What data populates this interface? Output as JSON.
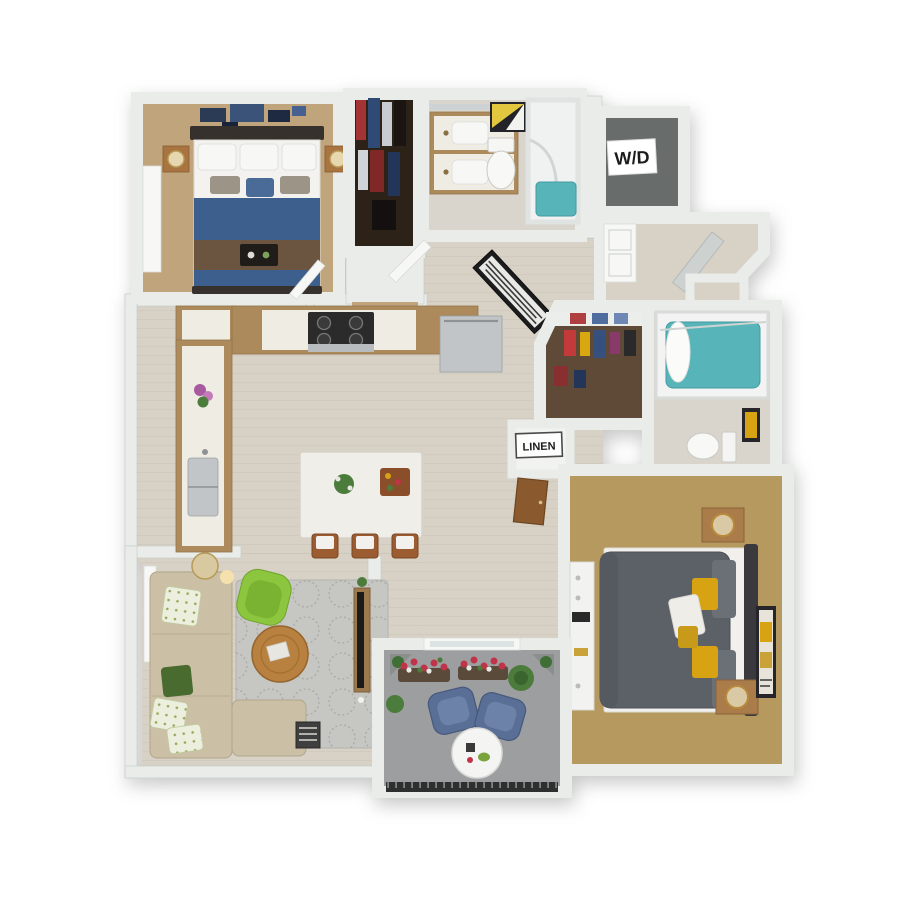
{
  "labels": {
    "washer_dryer": "W/D",
    "linen": "LINEN"
  },
  "palette": {
    "wall": "#e9ece9",
    "wall_edge": "#c7ccc9",
    "wood_floor": "#d7d1c6",
    "carpet_bedroom1": "#c0a47c",
    "carpet_bedroom2": "#b6995f",
    "closet_carpet_brown": "#5e4a36",
    "closet_interior_dark": "#2c2218",
    "laundry_interior": "#686c6b",
    "cabinet_wood": "#ac8a5c",
    "countertop": "#efece4",
    "stainless": "#c2c5c7",
    "bed1_blue": "#3d5f8e",
    "blanket_brown": "#6b5540",
    "bed2_gray": "#5c6167",
    "pillow_yellow": "#d7a312",
    "sofa_beige": "#cbbfa6",
    "accent_green": "#8cc63e",
    "table_wood": "#b9813f",
    "rug_gray": "#c6c6c3",
    "water_teal": "#57b5ba",
    "balcony_concrete": "#9d9ea0",
    "patio_chair_blue": "#5a6f95",
    "flower_red": "#c0344a",
    "plant_green": "#4c7c3c",
    "marble_floor": "#d9d5cc",
    "sign_background": "#ffffff",
    "sign_text": "#1c1c1c"
  },
  "plan": {
    "type": "3d-floor-plan",
    "rooms": [
      {
        "name": "bedroom-1",
        "furniture": [
          "blue queen bed with white pillows",
          "brown throw blanket",
          "decor tray",
          "two nightstands with lamps",
          "navy mosaic wall art",
          "window drape"
        ]
      },
      {
        "name": "walk-in-closet-1",
        "furniture": [
          "hanging clothes"
        ]
      },
      {
        "name": "bathroom-1",
        "furniture": [
          "double vanity with wood cabinet",
          "toilet",
          "geometric wall art",
          "glass shower with teal base"
        ]
      },
      {
        "name": "laundry-closet",
        "label": "W/D",
        "furniture": [
          "paneled door"
        ]
      },
      {
        "name": "entry-hall",
        "furniture": [
          "open front door",
          "coat closet"
        ]
      },
      {
        "name": "kitchen",
        "furniture": [
          "L-shaped wood cabinets with white counters",
          "gas range",
          "stainless dishwasher",
          "stainless sink",
          "flower pot",
          "white island with herbs and food board",
          "three wood stools"
        ]
      },
      {
        "name": "hallway",
        "furniture": [
          "large black framed art",
          "linen closet",
          "brown closet door"
        ]
      },
      {
        "name": "walk-in-closet-2",
        "furniture": [
          "white shelf with folded clothes",
          "colorful hanging clothes"
        ]
      },
      {
        "name": "bathroom-2",
        "furniture": [
          "tub with teal water and white shower curtain",
          "toilet",
          "wood vanity with marble top",
          "yellow wall art"
        ]
      },
      {
        "name": "bedroom-2",
        "furniture": [
          "gray queen bed with yellow and white pillows",
          "dark headboard",
          "two nightstands with round gold lamps",
          "white dresser with decor",
          "yellow abstract wall art"
        ]
      },
      {
        "name": "living-room",
        "furniture": [
          "beige sectional sofa with patterned pillows",
          "green accent chair",
          "round wood coffee table with magazine",
          "patterned gray rug",
          "floor lamp",
          "tv console with tv",
          "book stack",
          "window drape"
        ]
      },
      {
        "name": "balcony",
        "furniture": [
          "two blue wicker chairs",
          "round white table with drinks",
          "flower planter boxes",
          "green shrubs",
          "corner planters",
          "dark railing",
          "sliding glass door"
        ]
      }
    ]
  }
}
